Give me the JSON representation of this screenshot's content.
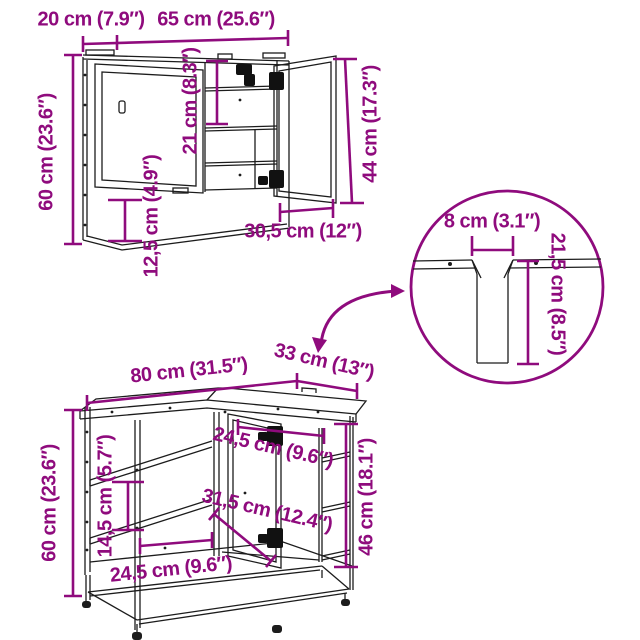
{
  "diagram_type": "furniture-dimension-diagram",
  "colors": {
    "dimension_accent": "#8F0B7D",
    "drawing_lines": "#1c1c1c",
    "background": "#ffffff"
  },
  "wall_cabinet": {
    "depth": "20 cm (7.9″)",
    "width": "65 cm (25.6″)",
    "height": "60 cm (23.6″)",
    "shelf_compartment_height": "21 cm (8.3″)",
    "bottom_compartment_height": "12,5 cm (4.9″)",
    "door_height": "44 cm (17.3″)",
    "door_width": "30,5 cm (12″)"
  },
  "detail_view": {
    "cutout_width": "8 cm (3.1″)",
    "cutout_depth": "21,5 cm (8.5″)"
  },
  "vanity_cabinet": {
    "width": "80 cm (31.5″)",
    "depth": "33 cm (13″)",
    "height": "60 cm (23.6″)",
    "door_opening_width": "24,5 cm (9.6″)",
    "interior_depth": "31,5 cm (12.4″)",
    "shelf_spacing": "14,5 cm (5.7″)",
    "shelf_width": "24,5 cm (9.6″)",
    "open_side_height": "46 cm (18.1″)"
  }
}
